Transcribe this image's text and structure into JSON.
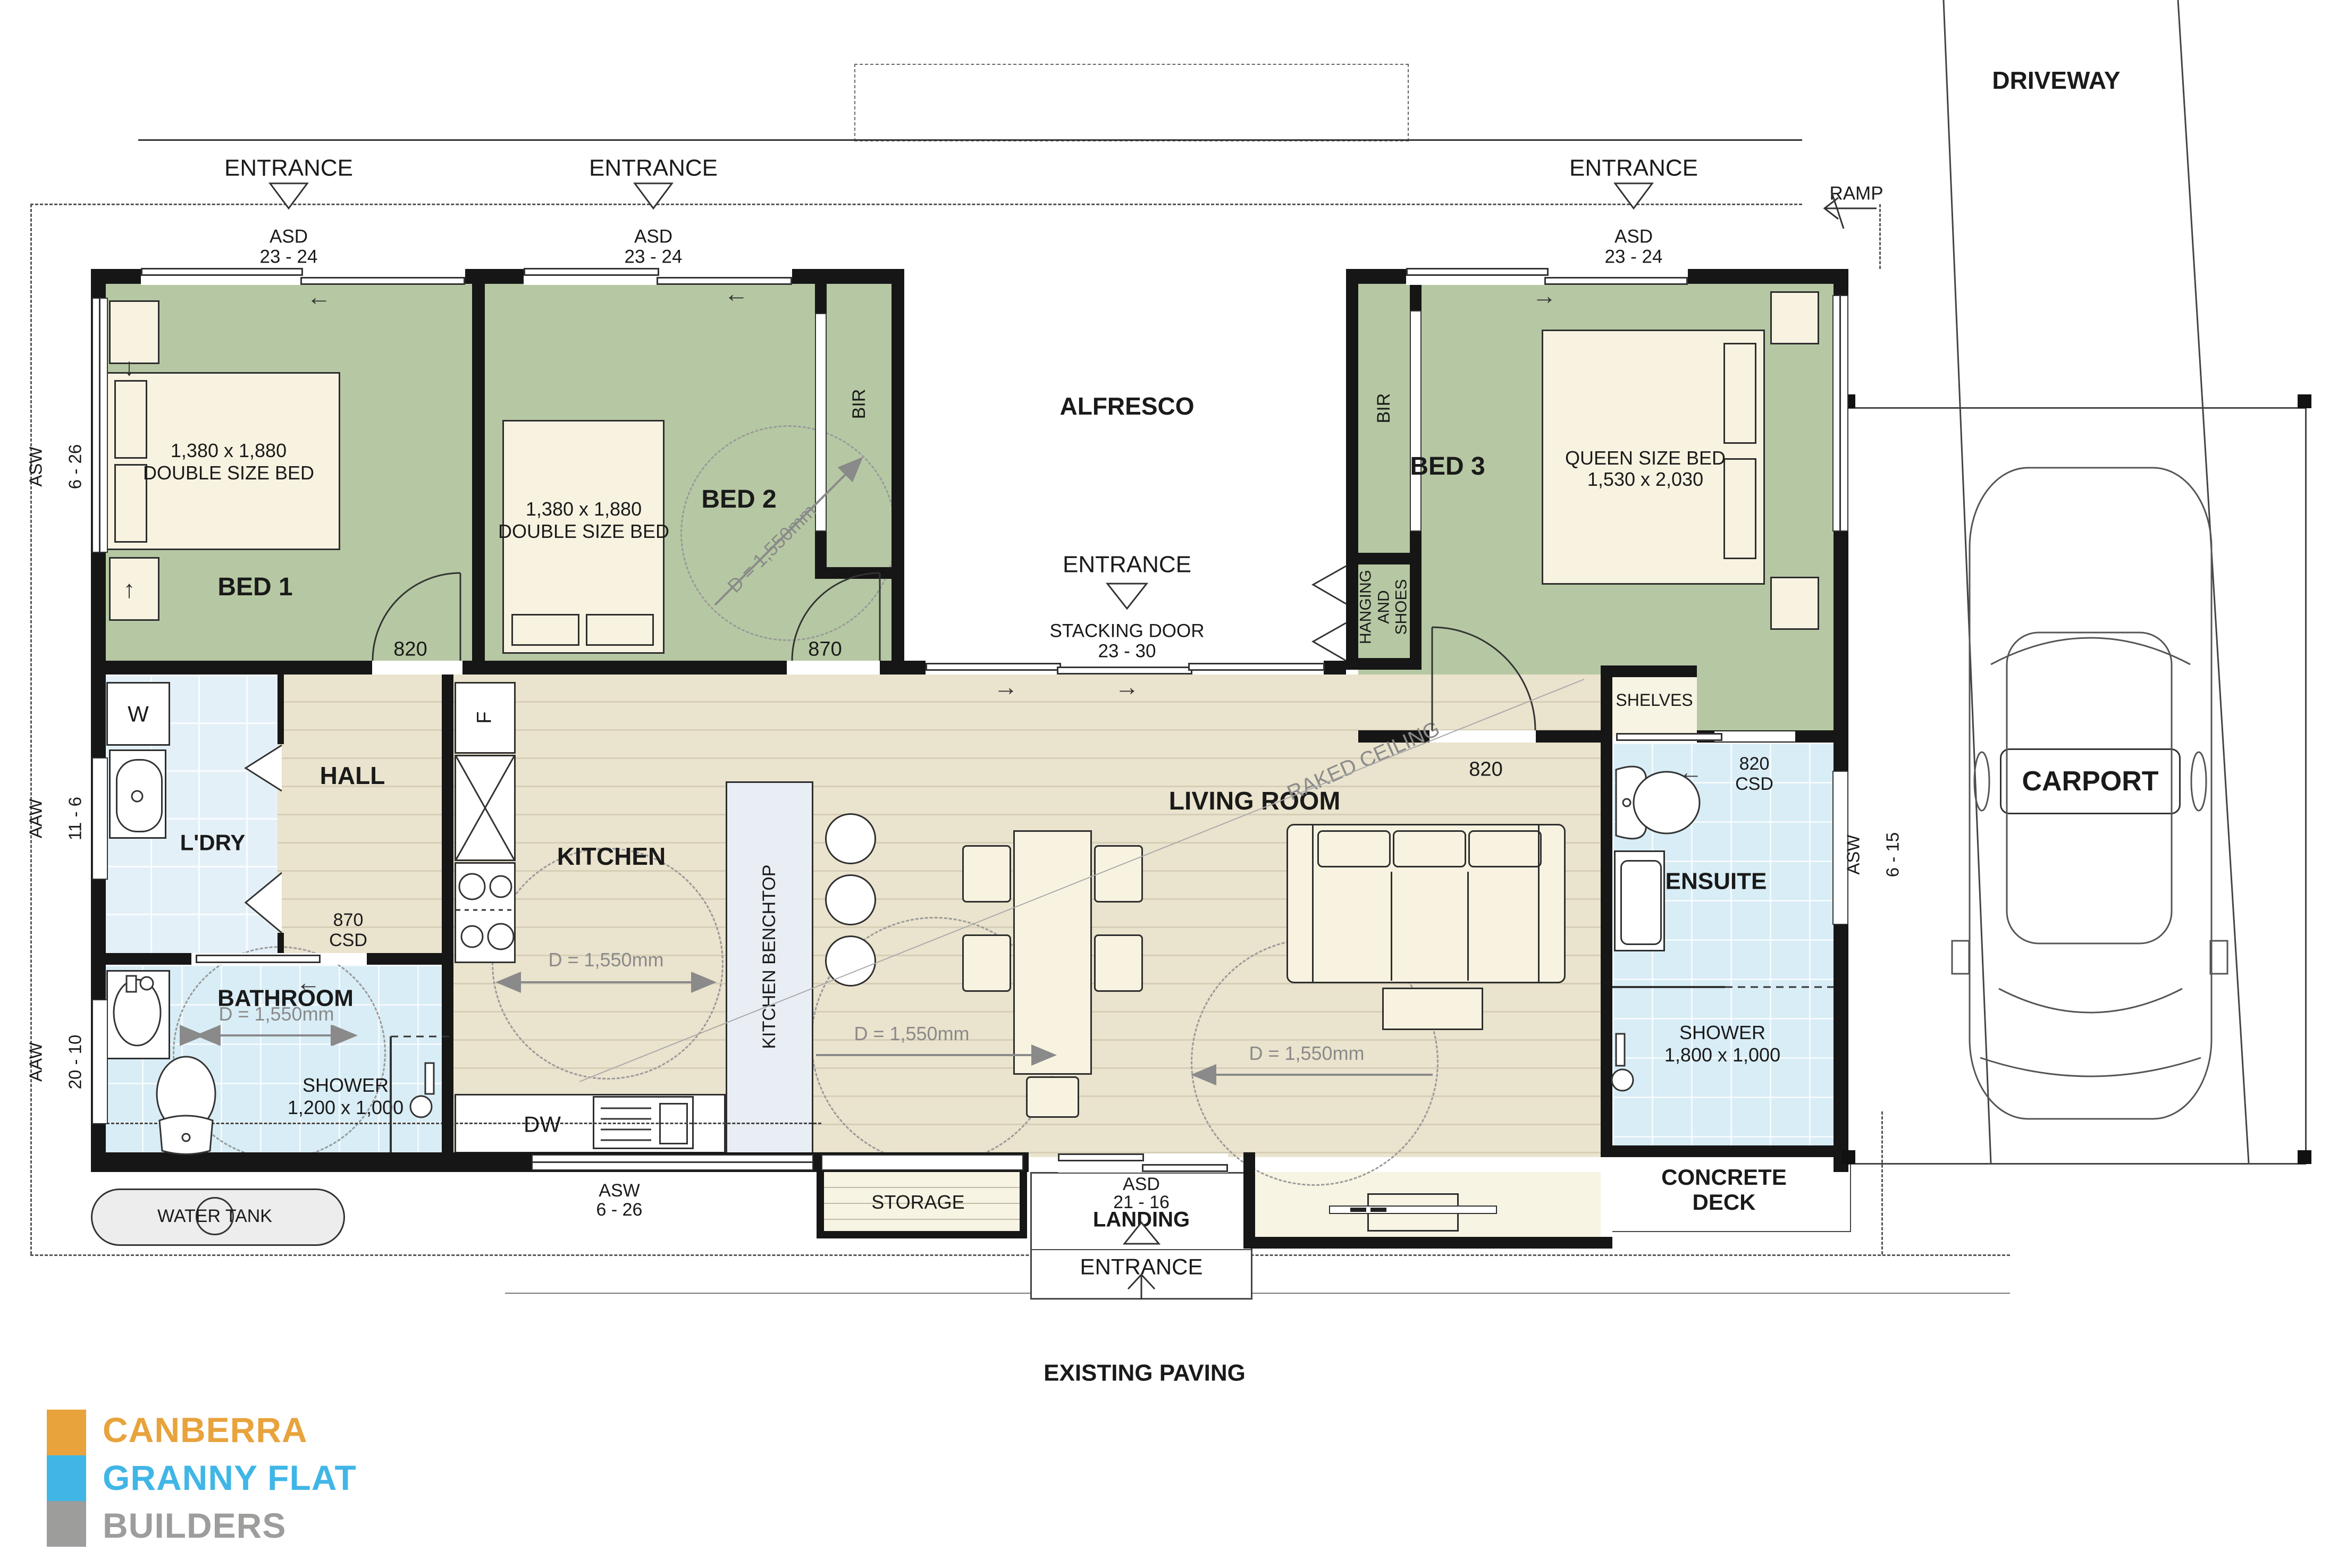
{
  "site": {
    "driveway": "DRIVEWAY",
    "ramp": "RAMP",
    "alfresco": "ALFRESCO",
    "carport": "CARPORT",
    "concrete_deck": "CONCRETE\nDECK",
    "existing_paving": "EXISTING PAVING",
    "water_tank": "WATER TANK",
    "entrance": "ENTRANCE"
  },
  "rooms": {
    "bed1": "BED 1",
    "bed2": "BED 2",
    "bed3": "BED 3",
    "hall": "HALL",
    "ldry": "L'DRY",
    "kitchen": "KITCHEN",
    "benchtop": "KITCHEN BENCHTOP",
    "living": "LIVING ROOM",
    "raked": "RAKED CEILING",
    "bathroom": "BATHROOM",
    "ensuite": "ENSUITE",
    "storage": "STORAGE",
    "landing": "LANDING",
    "shelves": "SHELVES",
    "bir": "BIR",
    "hanging": "HANGING\nAND\nSHOES"
  },
  "furniture": {
    "double_bed_size": "1,380 x 1,880",
    "double_bed_type": "DOUBLE SIZE BED",
    "queen_bed_type": "QUEEN SIZE BED",
    "queen_bed_size": "1,530 x 2,030",
    "washer": "W",
    "fridge": "F",
    "dishwasher": "DW"
  },
  "openings": {
    "asd": "ASD",
    "asd_size": "23 - 24",
    "asd_landing_size": "21 - 16",
    "stacking_door": "STACKING DOOR",
    "stacking_size": "23 - 30",
    "asw": "ASW",
    "asw_6_26": "6 - 26",
    "asw_6_15": "6 - 15",
    "aaw": "AAW",
    "aaw_11_6": "11 - 6",
    "aaw_20_10": "20 - 10",
    "door_820": "820",
    "door_870": "870",
    "csd": "CSD",
    "clearance": "D = 1,550mm",
    "shower": "SHOWER",
    "shower_bath_size": "1,200 x 1,000",
    "shower_ensuite_size": "1,800 x 1,000"
  },
  "logo": {
    "line1": "CANBERRA",
    "line2": "GRANNY FLAT",
    "line3": "BUILDERS",
    "color1": "#E8A33D",
    "color2": "#41B6E6",
    "color3": "#9D9D9C"
  }
}
